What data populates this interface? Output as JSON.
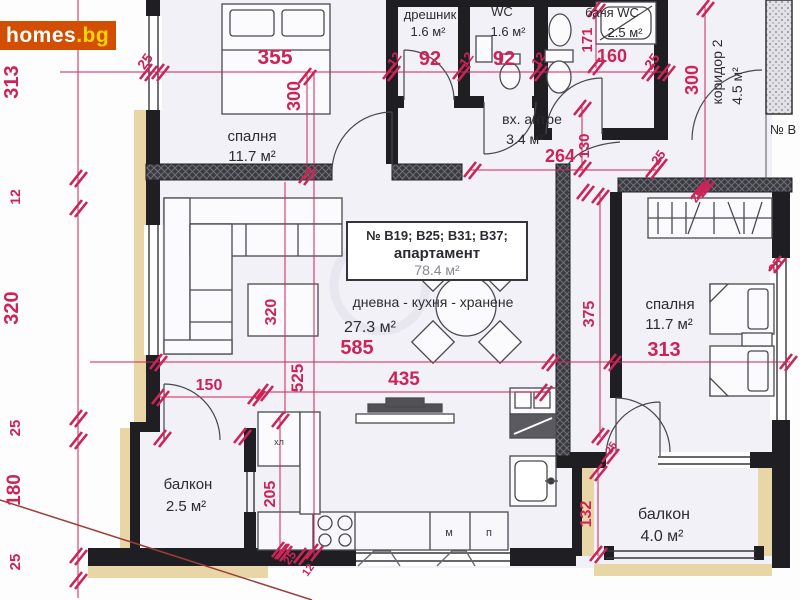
{
  "logo": {
    "main": "homes",
    "suffix": ".bg"
  },
  "rooms": {
    "bedroom1": {
      "name": "спалня",
      "area": "11.7 м²"
    },
    "closet": {
      "name": "дрешник",
      "area": "1.6 м²"
    },
    "wc": {
      "name": "WC",
      "area": "1.6 м²"
    },
    "bath": {
      "name": "баня WC",
      "area": "2.5 м²"
    },
    "entry": {
      "name": "вх. антре",
      "area": "3.4 м²"
    },
    "corridor": {
      "name": "коридор 2",
      "area": "4.5 м²"
    },
    "living": {
      "name": "дневна - кухня - хранене",
      "area": "27.3 м²"
    },
    "bedroom2": {
      "name": "спалня",
      "area": "11.7 м²"
    },
    "balcony1": {
      "name": "балкон",
      "area": "2.5 м²"
    },
    "balcony2": {
      "name": "балкон",
      "area": "4.0 м²"
    }
  },
  "apartment": {
    "line1": "№ В19; В25; В31; В37;",
    "line2": "апартамент",
    "line3": "78.4 м²"
  },
  "neighbor_label": "№ В",
  "furniture": {
    "fridge": "хл",
    "washer": "м",
    "pantry": "п"
  },
  "dims": {
    "d313l": "313",
    "d12": "12",
    "d320l": "320",
    "d25": "25",
    "d180": "180",
    "d355": "355",
    "d92": "92",
    "d160": "160",
    "d300a": "300",
    "d171": "171",
    "d300b": "300",
    "d264": "264",
    "d130": "130",
    "d585": "585",
    "d525": "525",
    "d435": "435",
    "d320c": "320",
    "d375": "375",
    "d313r": "313",
    "d150": "150",
    "d205": "205",
    "d132": "132"
  },
  "colors": {
    "dimension": "#cc2457",
    "wall": "#1f1f23",
    "insulation": "#e8d6a6",
    "floor": "#f2f1f7",
    "logo_bg": "#d24e00",
    "logo_suffix": "#ffd400",
    "diagonal_line": "#9c3d3d"
  }
}
